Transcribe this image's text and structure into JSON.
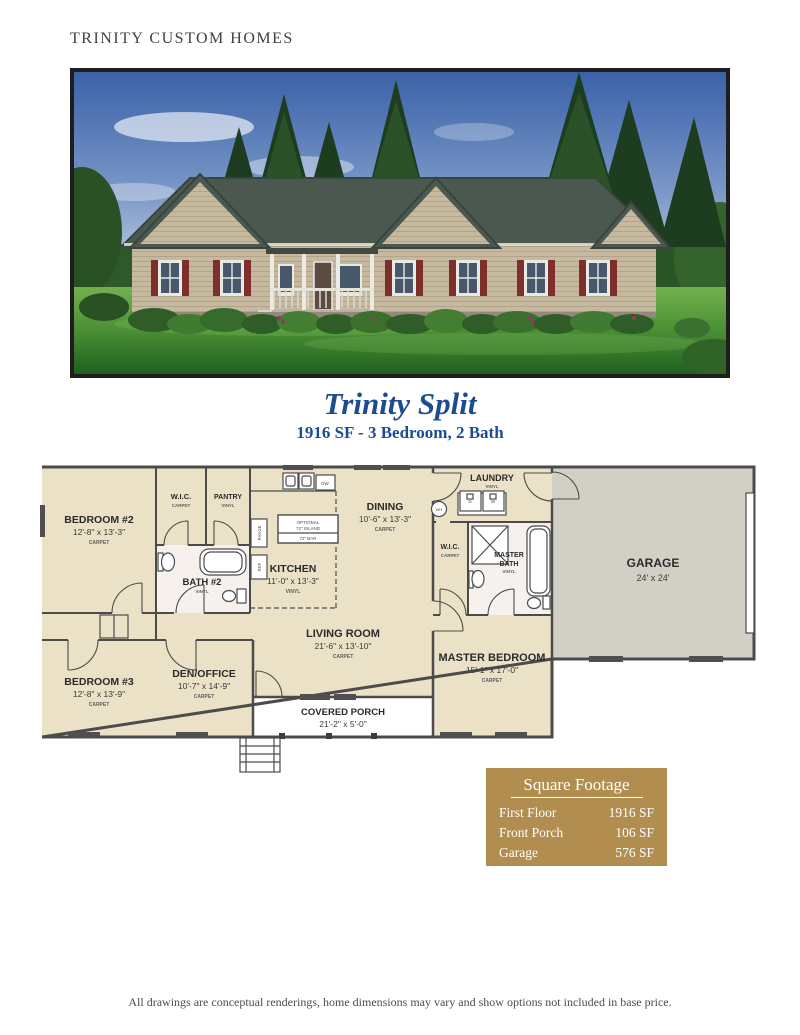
{
  "brand": {
    "name": "TRINITY CUSTOM HOMES"
  },
  "model": {
    "title": "Trinity Split",
    "subtitle": "1916 SF - 3 Bedroom, 2 Bath"
  },
  "floor_plan": {
    "bedroom2": {
      "name": "BEDROOM #2",
      "dims": "12'-8\" x 13'-3\"",
      "floor": "CARPET"
    },
    "hall_wic": {
      "name": "W.I.C.",
      "floor": "CARPET"
    },
    "pantry": {
      "name": "PANTRY",
      "floor": "VINYL"
    },
    "bath2": {
      "name": "BATH #2",
      "floor": "VINYL"
    },
    "kitchen": {
      "name": "KITCHEN",
      "dims": "11'-0\" x 13'-3\"",
      "floor": "VINYL"
    },
    "dining": {
      "name": "DINING",
      "dims": "10'-6\" x 13'-3\"",
      "floor": "CARPET"
    },
    "laundry": {
      "name": "LAUNDRY",
      "floor": "VINYL"
    },
    "master_wic": {
      "name": "W.I.C.",
      "floor": "CARPET"
    },
    "master_bath": {
      "name_line1": "MASTER",
      "name_line2": "BATH",
      "floor": "VINYL"
    },
    "garage": {
      "name": "GARAGE",
      "dims": "24' x 24'"
    },
    "bedroom3": {
      "name": "BEDROOM #3",
      "dims": "12'-8\" x 13'-9\"",
      "floor": "CARPET"
    },
    "den_office": {
      "name": "DEN/OFFICE",
      "dims": "10'-7\" x 14'-9\"",
      "floor": "CARPET"
    },
    "living_room": {
      "name": "LIVING ROOM",
      "dims": "21'-6\" x 13'-10\"",
      "floor": "CARPET"
    },
    "master_bedroom": {
      "name": "MASTER BEDROOM",
      "dims": "15'-1\" x 17'-0\"",
      "floor": "CARPET"
    },
    "covered_porch": {
      "name": "COVERED PORCH",
      "dims": "21'-2\" x 5'-0\""
    },
    "annotations": {
      "island_line1": "OPTIONAL",
      "island_line2": "72\" ISLAND",
      "bar": "72\" BAR",
      "dishwasher": "DW",
      "range": "RANGE",
      "refrigerator": "REF",
      "dryer": "D",
      "washer": "W",
      "water_heater": "WH"
    }
  },
  "square_footage": {
    "title": "Square Footage",
    "rows": [
      {
        "label": "First Floor",
        "value": "1916 SF"
      },
      {
        "label": "Front Porch",
        "value": "106 SF"
      },
      {
        "label": "Garage",
        "value": "576 SF"
      }
    ]
  },
  "footer": {
    "disclaimer": "All drawings are conceptual renderings, home dimensions may vary and show options not included in base price."
  },
  "colors": {
    "accent_blue": "#1d4c93",
    "panel_gold": "#b18e50",
    "plan_beige": "#eae1c6",
    "plan_bath_white": "#f7f1ee",
    "plan_garage_gray": "#d2d0c5",
    "plan_wall_gray": "#4b4b4b",
    "shutter_red": "#7e2f2b"
  }
}
